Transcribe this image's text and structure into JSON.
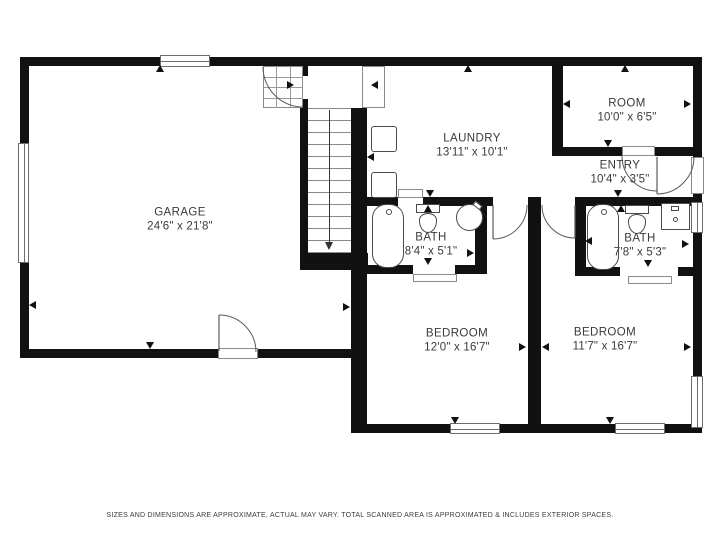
{
  "footer": {
    "text": "SIZES AND DIMENSIONS ARE APPROXIMATE, ACTUAL MAY VARY. TOTAL SCANNED AREA IS APPROXIMATED & INCLUDES EXTERIOR SPACES."
  },
  "colors": {
    "wall": "#111111",
    "line": "#6b6b6b",
    "fixture": "#4a4a4a",
    "text": "#3a3a3a"
  },
  "rooms": [
    {
      "id": "garage",
      "name": "GARAGE",
      "dims": "24'6\" x 21'8\"",
      "cx": 180,
      "cy": 220
    },
    {
      "id": "laundry",
      "name": "LAUNDRY",
      "dims": "13'11\" x 10'1\"",
      "cx": 472,
      "cy": 146
    },
    {
      "id": "room",
      "name": "ROOM",
      "dims": "10'0\" x 6'5\"",
      "cx": 627,
      "cy": 111
    },
    {
      "id": "entry",
      "name": "ENTRY",
      "dims": "10'4\" x 3'5\"",
      "cx": 620,
      "cy": 173
    },
    {
      "id": "bath-1",
      "name": "BATH",
      "dims": "8'4\" x 5'1\"",
      "cx": 431,
      "cy": 245
    },
    {
      "id": "bath-2",
      "name": "BATH",
      "dims": "7'8\" x 5'3\"",
      "cx": 640,
      "cy": 246
    },
    {
      "id": "bedroom-1",
      "name": "BEDROOM",
      "dims": "12'0\" x 16'7\"",
      "cx": 457,
      "cy": 341
    },
    {
      "id": "bedroom-2",
      "name": "BEDROOM",
      "dims": "11'7\" x 16'7\"",
      "cx": 605,
      "cy": 340
    }
  ],
  "walls": [
    {
      "x": 20,
      "y": 57,
      "w": 682,
      "h": 9
    },
    {
      "x": 20,
      "y": 57,
      "w": 9,
      "h": 301
    },
    {
      "x": 20,
      "y": 349,
      "w": 340,
      "h": 9
    },
    {
      "x": 300,
      "y": 57,
      "w": 8,
      "h": 196
    },
    {
      "x": 351,
      "y": 108,
      "w": 16,
      "h": 170
    },
    {
      "x": 351,
      "y": 270,
      "w": 16,
      "h": 163
    },
    {
      "x": 300,
      "y": 253,
      "w": 68,
      "h": 17
    },
    {
      "x": 351,
      "y": 197,
      "w": 351,
      "h": 9
    },
    {
      "x": 475,
      "y": 197,
      "w": 12,
      "h": 77
    },
    {
      "x": 351,
      "y": 265,
      "w": 136,
      "h": 9
    },
    {
      "x": 528,
      "y": 197,
      "w": 13,
      "h": 236
    },
    {
      "x": 575,
      "y": 197,
      "w": 11,
      "h": 79
    },
    {
      "x": 575,
      "y": 267,
      "w": 127,
      "h": 9
    },
    {
      "x": 552,
      "y": 57,
      "w": 11,
      "h": 99
    },
    {
      "x": 552,
      "y": 147,
      "w": 150,
      "h": 9
    },
    {
      "x": 355,
      "y": 424,
      "w": 347,
      "h": 9
    },
    {
      "x": 693,
      "y": 57,
      "w": 9,
      "h": 376
    }
  ],
  "door_gaps": [
    {
      "x": 218,
      "y": 349,
      "w": 40,
      "h": 9
    },
    {
      "x": 300,
      "y": 76,
      "w": 8,
      "h": 23
    },
    {
      "x": 398,
      "y": 197,
      "w": 25,
      "h": 9
    },
    {
      "x": 493,
      "y": 197,
      "w": 35,
      "h": 9
    },
    {
      "x": 541,
      "y": 197,
      "w": 34,
      "h": 9
    },
    {
      "x": 413,
      "y": 265,
      "w": 42,
      "h": 9
    },
    {
      "x": 620,
      "y": 267,
      "w": 58,
      "h": 9
    },
    {
      "x": 622,
      "y": 147,
      "w": 33,
      "h": 9
    },
    {
      "x": 693,
      "y": 157,
      "w": 9,
      "h": 37
    }
  ],
  "windows": [
    {
      "x": 160,
      "y": 55,
      "w": 50,
      "h": 12,
      "o": "h"
    },
    {
      "x": 18,
      "y": 143,
      "w": 11,
      "h": 120,
      "o": "v"
    },
    {
      "x": 450,
      "y": 423,
      "w": 50,
      "h": 11,
      "o": "h"
    },
    {
      "x": 615,
      "y": 423,
      "w": 50,
      "h": 11,
      "o": "h"
    },
    {
      "x": 691,
      "y": 202,
      "w": 12,
      "h": 31,
      "o": "v"
    },
    {
      "x": 691,
      "y": 376,
      "w": 12,
      "h": 52,
      "o": "v"
    }
  ],
  "thresholds": [
    {
      "x": 362,
      "y": 66,
      "w": 23,
      "h": 42
    },
    {
      "x": 398,
      "y": 189,
      "w": 25,
      "h": 9
    },
    {
      "x": 413,
      "y": 274,
      "w": 44,
      "h": 8
    },
    {
      "x": 628,
      "y": 276,
      "w": 44,
      "h": 8
    },
    {
      "x": 218,
      "y": 348,
      "w": 40,
      "h": 11
    },
    {
      "x": 622,
      "y": 146,
      "w": 33,
      "h": 10
    },
    {
      "x": 691,
      "y": 157,
      "w": 13,
      "h": 37
    }
  ],
  "winder_grid": {
    "x": 263,
    "y": 66,
    "w": 40,
    "h": 42,
    "cols": 3,
    "rows": 4
  },
  "stairs": {
    "x": 308,
    "y": 108,
    "w": 43,
    "h": 146,
    "tread_step": 12,
    "runner_x": 329,
    "runner_y1": 110,
    "runner_y2": 242,
    "arrow_tip_y": 250
  },
  "arcs": [
    {
      "name": "garage-side-door-swing",
      "d": "M219,315 A37,37 0 0 1 256,352"
    },
    {
      "name": "garage-winder-door-swing",
      "d": "M263,67 A40,40 0 0 0 303,107"
    },
    {
      "name": "bedroom-1-door-swing",
      "d": "M527,205 A34,34 0 0 1 493,239"
    },
    {
      "name": "bedroom-2-door-swing",
      "d": "M542,205 A33,33 0 0 0 575,238"
    },
    {
      "name": "room-door-swing",
      "d": "M622,156 A35,35 0 0 0 657,191"
    },
    {
      "name": "front-door-swing",
      "d": "M657,194 A37,37 0 0 0 694,157"
    }
  ],
  "door_leaves": [
    {
      "x1": 219,
      "y1": 315,
      "x2": 219,
      "y2": 351
    },
    {
      "x1": 493,
      "y1": 205,
      "x2": 493,
      "y2": 239
    },
    {
      "x1": 575,
      "y1": 205,
      "x2": 575,
      "y2": 238
    },
    {
      "x1": 657,
      "y1": 157,
      "x2": 657,
      "y2": 194
    }
  ],
  "fixtures": [
    {
      "type": "tub",
      "x": 372,
      "y": 204,
      "w": 32,
      "h": 64
    },
    {
      "type": "tub",
      "x": 587,
      "y": 204,
      "w": 32,
      "h": 66
    },
    {
      "type": "toilet",
      "x": 416,
      "y": 204,
      "w": 24,
      "h": 30
    },
    {
      "type": "toilet",
      "x": 625,
      "y": 205,
      "w": 24,
      "h": 30
    },
    {
      "type": "sink-round",
      "x": 456,
      "y": 204,
      "w": 27,
      "h": 27
    },
    {
      "type": "vanity",
      "x": 661,
      "y": 203,
      "w": 29,
      "h": 27
    },
    {
      "type": "appliance",
      "x": 371,
      "y": 126,
      "w": 26,
      "h": 26
    },
    {
      "type": "appliance",
      "x": 371,
      "y": 172,
      "w": 26,
      "h": 26
    }
  ],
  "markers": [
    {
      "x": 160,
      "y": 69,
      "dir": "up"
    },
    {
      "x": 468,
      "y": 69,
      "dir": "up"
    },
    {
      "x": 625,
      "y": 69,
      "dir": "up"
    },
    {
      "x": 291,
      "y": 85,
      "dir": "right"
    },
    {
      "x": 375,
      "y": 85,
      "dir": "left"
    },
    {
      "x": 371,
      "y": 157,
      "dir": "left"
    },
    {
      "x": 33,
      "y": 305,
      "dir": "left"
    },
    {
      "x": 150,
      "y": 346,
      "dir": "down"
    },
    {
      "x": 347,
      "y": 307,
      "dir": "right"
    },
    {
      "x": 430,
      "y": 194,
      "dir": "down"
    },
    {
      "x": 608,
      "y": 144,
      "dir": "down"
    },
    {
      "x": 618,
      "y": 194,
      "dir": "down"
    },
    {
      "x": 567,
      "y": 104,
      "dir": "left"
    },
    {
      "x": 688,
      "y": 104,
      "dir": "right"
    },
    {
      "x": 428,
      "y": 209,
      "dir": "up"
    },
    {
      "x": 428,
      "y": 262,
      "dir": "down"
    },
    {
      "x": 471,
      "y": 253,
      "dir": "right"
    },
    {
      "x": 621,
      "y": 209,
      "dir": "up"
    },
    {
      "x": 648,
      "y": 264,
      "dir": "down"
    },
    {
      "x": 589,
      "y": 241,
      "dir": "left"
    },
    {
      "x": 686,
      "y": 244,
      "dir": "right"
    },
    {
      "x": 523,
      "y": 347,
      "dir": "right"
    },
    {
      "x": 546,
      "y": 347,
      "dir": "left"
    },
    {
      "x": 455,
      "y": 421,
      "dir": "down"
    },
    {
      "x": 610,
      "y": 421,
      "dir": "down"
    },
    {
      "x": 688,
      "y": 347,
      "dir": "right"
    }
  ]
}
